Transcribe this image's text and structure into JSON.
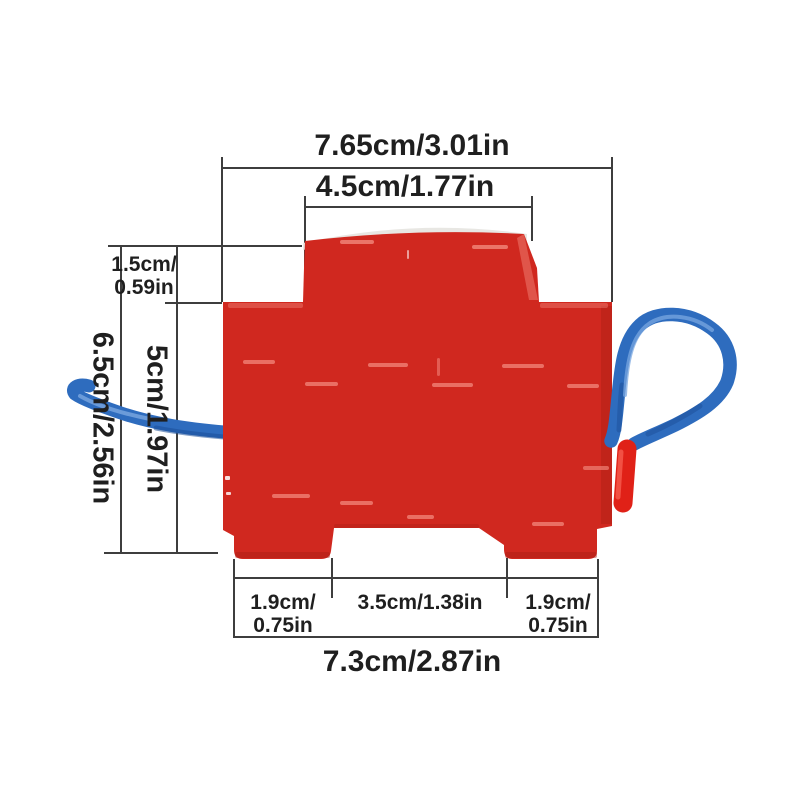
{
  "figure": {
    "kind": "product-dimension-diagram",
    "subject": "red surge-protector style device with blue wire leads"
  },
  "labels": {
    "top_width": "7.65cm/3.01in",
    "cap_width": "4.5cm/1.77in",
    "cap_height_l1": "1.5cm/",
    "cap_height_l2": "0.59in",
    "body_height": "5cm/1.97in",
    "total_height": "6.5cm/2.56in",
    "foot_left_l1": "1.9cm/",
    "foot_left_l2": "0.75in",
    "foot_gap": "3.5cm/1.38in",
    "foot_right_l1": "1.9cm/",
    "foot_right_l2": "0.75in",
    "bottom_width": "7.3cm/2.87in"
  },
  "colors": {
    "background": "#ffffff",
    "line": "#3e3e3e",
    "text": "#1f1f1f",
    "body_red": "#d0281f",
    "body_red_deep": "#a81d15",
    "cap_sheen": "#e8e7e3",
    "detail_highlight": "#f08176",
    "speck_white": "#ffffff",
    "wire_blue": "#2e6cbe",
    "wire_blue_light": "#7aa7e0",
    "wire_blue_dark": "#1c4e97",
    "sleeve_red": "#e02117",
    "sleeve_red_light": "#f4584b"
  }
}
